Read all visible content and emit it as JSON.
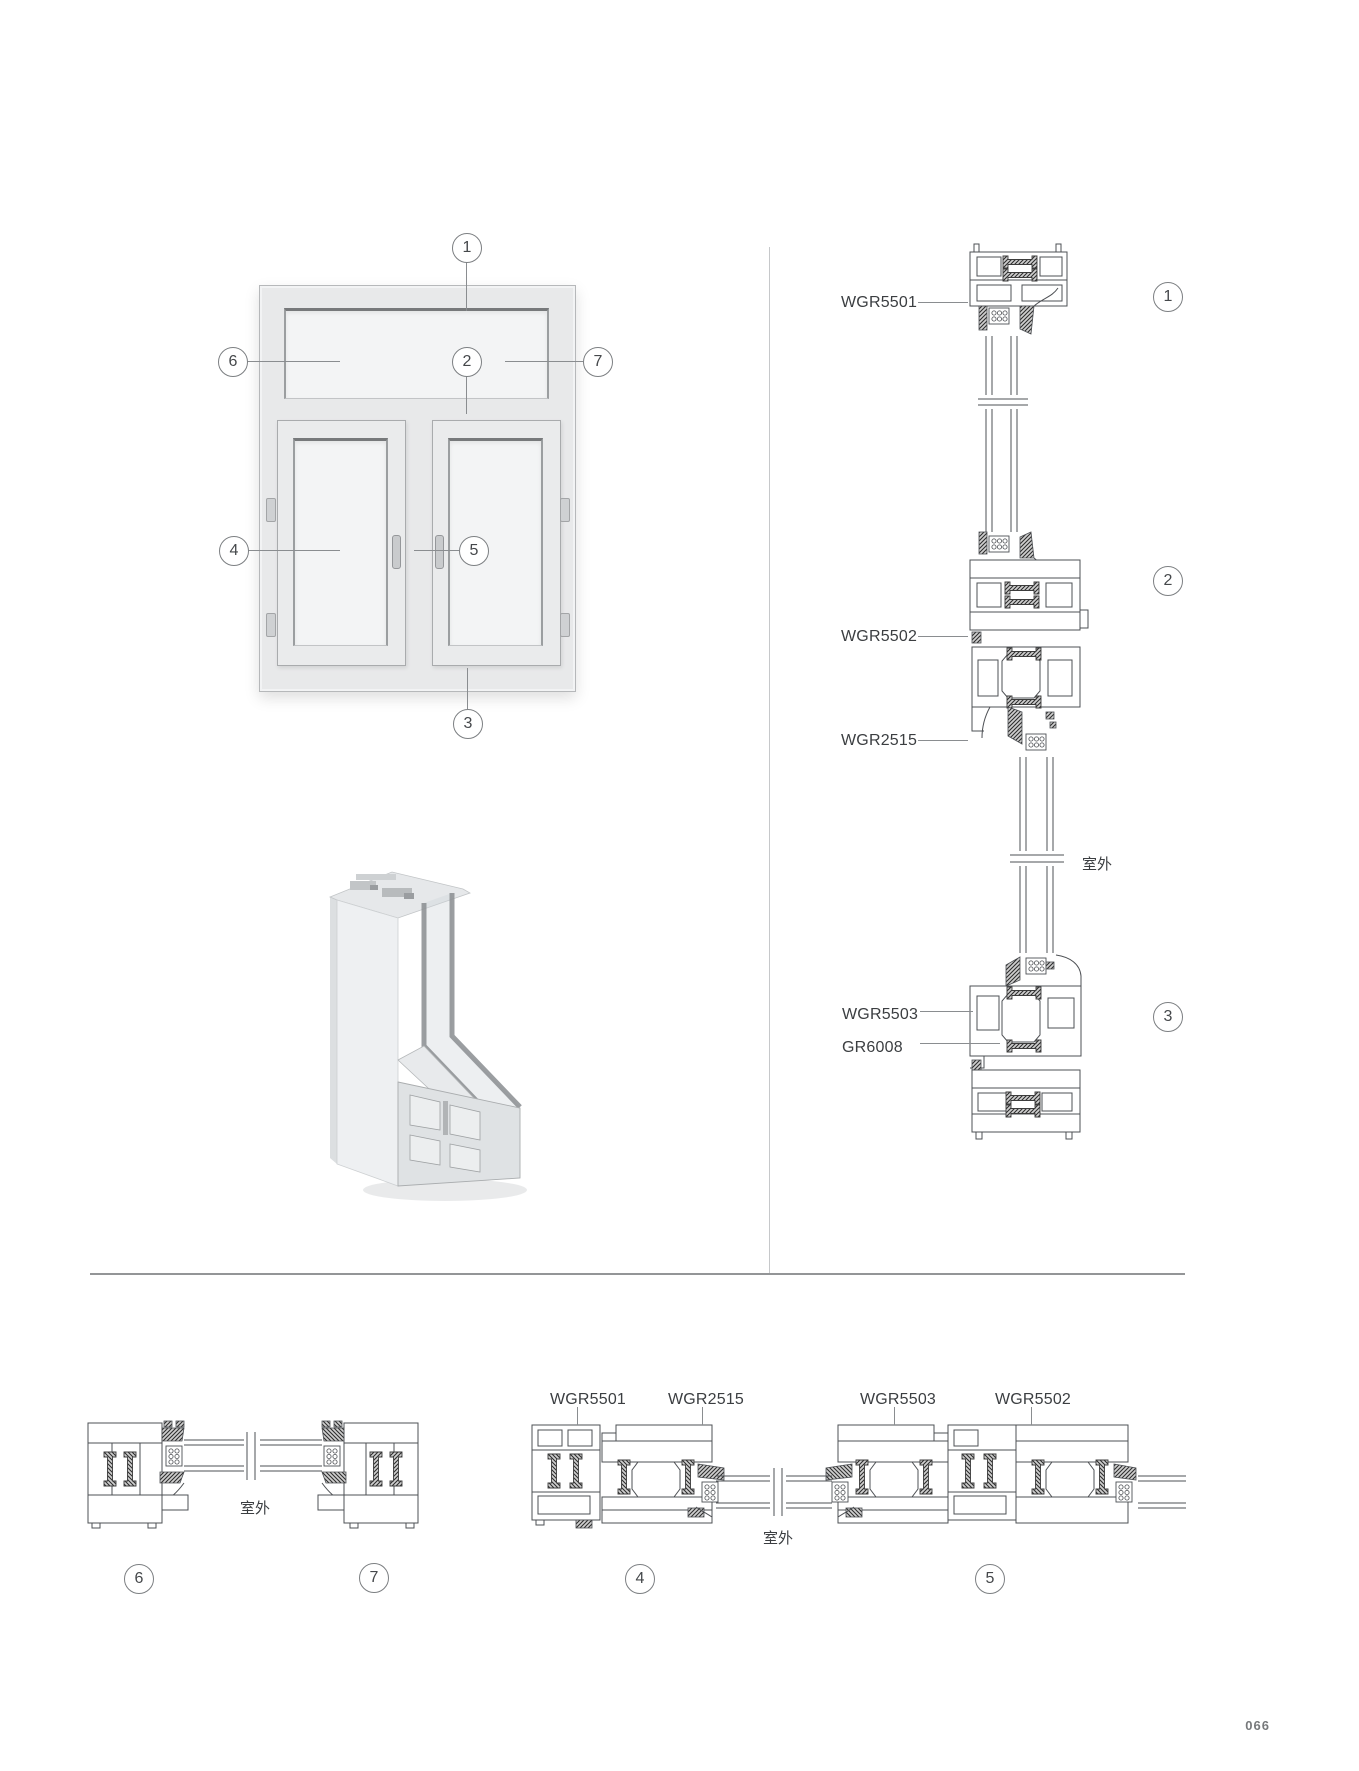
{
  "page": {
    "number": "066"
  },
  "colors": {
    "line": "#4d5054",
    "label_text": "#3b3e41",
    "divider": "#97999c",
    "frame_fill": "#e8e9ea",
    "glass_fill": "#f3f4f5",
    "hatch_dark": "#2e2e2e"
  },
  "elevation": {
    "callouts": [
      "1",
      "2",
      "3",
      "4",
      "5",
      "6",
      "7"
    ]
  },
  "vertical_section": {
    "labels": [
      "WGR5501",
      "WGR5502",
      "WGR2515",
      "WGR5503",
      "GR6008"
    ],
    "outdoor_label": "室外",
    "callouts": [
      "1",
      "2",
      "3"
    ]
  },
  "bottom_left_section": {
    "outdoor_label": "室外",
    "callouts": [
      "6",
      "7"
    ]
  },
  "bottom_right_section": {
    "labels": [
      "WGR5501",
      "WGR2515",
      "WGR5503",
      "WGR5502"
    ],
    "outdoor_label": "室外",
    "callouts": [
      "4",
      "5"
    ]
  }
}
